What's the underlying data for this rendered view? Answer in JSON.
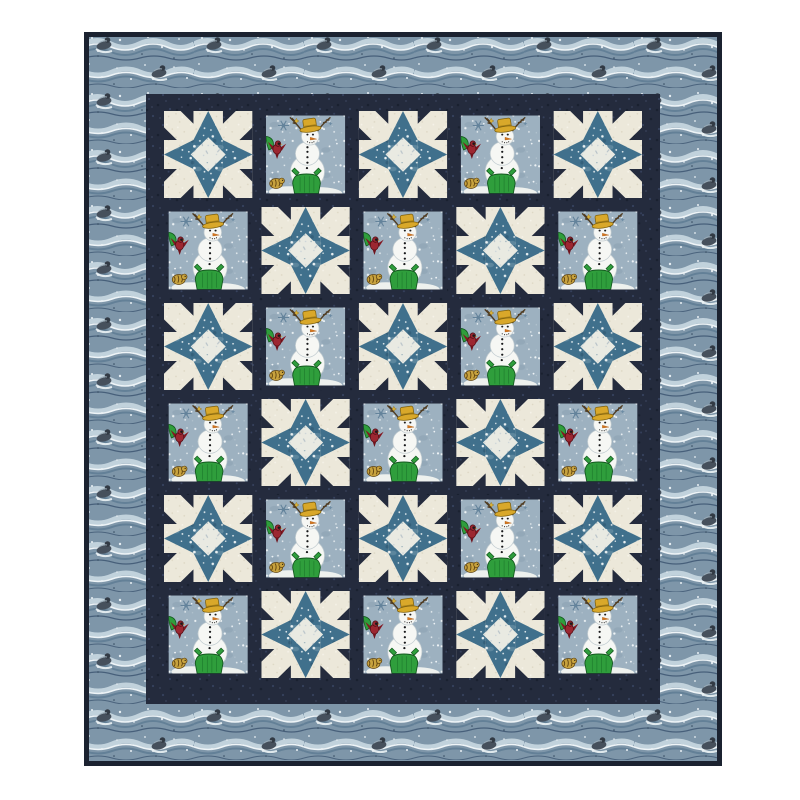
{
  "scene": {
    "type": "product-photo",
    "subject": "snowman and star patchwork quilt on white background",
    "background_color": "#ffffff"
  },
  "quilt": {
    "rows": 6,
    "cols": 5,
    "block_types": [
      "star",
      "snowman"
    ],
    "grid": [
      [
        "star",
        "snowman",
        "star",
        "snowman",
        "star"
      ],
      [
        "snowman",
        "star",
        "snowman",
        "star",
        "snowman"
      ],
      [
        "star",
        "snowman",
        "star",
        "snowman",
        "star"
      ],
      [
        "snowman",
        "star",
        "snowman",
        "star",
        "snowman"
      ],
      [
        "star",
        "snowman",
        "star",
        "snowman",
        "star"
      ],
      [
        "snowman",
        "star",
        "snowman",
        "star",
        "snowman"
      ]
    ],
    "palette": {
      "binding": "#1b2230",
      "sashing_navy": "#242b3d",
      "background_cream": "#ece8da",
      "star_point_blue": "#40708c",
      "star_center_light": "#e9eae2",
      "panel_sky": "#9db1c0",
      "border_blue": "#7e96a9",
      "snowman_white": "#f6f7f4",
      "hat_yellow": "#d9a82a",
      "coat_green": "#2f9e3c",
      "bird_red": "#9c2731",
      "critter_tan": "#c7a23e"
    }
  }
}
